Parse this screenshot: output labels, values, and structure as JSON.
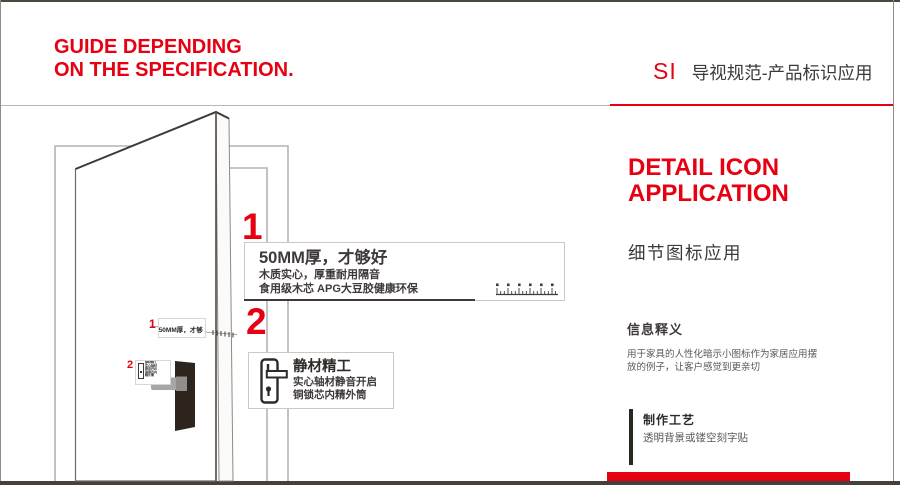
{
  "colors": {
    "accent_red": "#e60012",
    "dark_text": "#3f3a39",
    "muted_text": "#595757",
    "frame_line": "#b6b3b0"
  },
  "header": {
    "title_line1": "GUIDE DEPENDING",
    "title_line2": "ON THE SPECIFICATION.",
    "brand": "SI",
    "doc_title": "导视规范-产品标识应用"
  },
  "door": {
    "name": "木门",
    "subtitle": "材质与厚度"
  },
  "callouts": [
    {
      "number": "1",
      "title": "50MM厚，才够好",
      "lines": [
        "木质实心，厚重耐用隔音",
        "食用级木芯 APG大豆胶健康环保"
      ]
    },
    {
      "number": "2",
      "title": "静材精工",
      "lines": [
        "实心轴材静音开启",
        "铜锁芯内精外筒"
      ]
    }
  ],
  "mini_labels": [
    {
      "number": "1",
      "text": "50MM厚，才够好 木质实心，厚重耐用隔音 食用级木芯APG大豆胶健康环保"
    },
    {
      "number": "2",
      "text": "静材精工 实心轴材静音开启 铜锁芯内精外筒"
    }
  ],
  "panel": {
    "title_line1": "DETAIL ICON",
    "title_line2": "APPLICATION",
    "subtitle": "细节图标应用",
    "info_heading": "信息释义",
    "info_body": "用于家具的人性化暗示小图标作为家居应用摆放的例子，让客户感觉到更亲切",
    "craft_heading": "制作工艺",
    "craft_body": "透明背景或镂空刻字贴"
  }
}
